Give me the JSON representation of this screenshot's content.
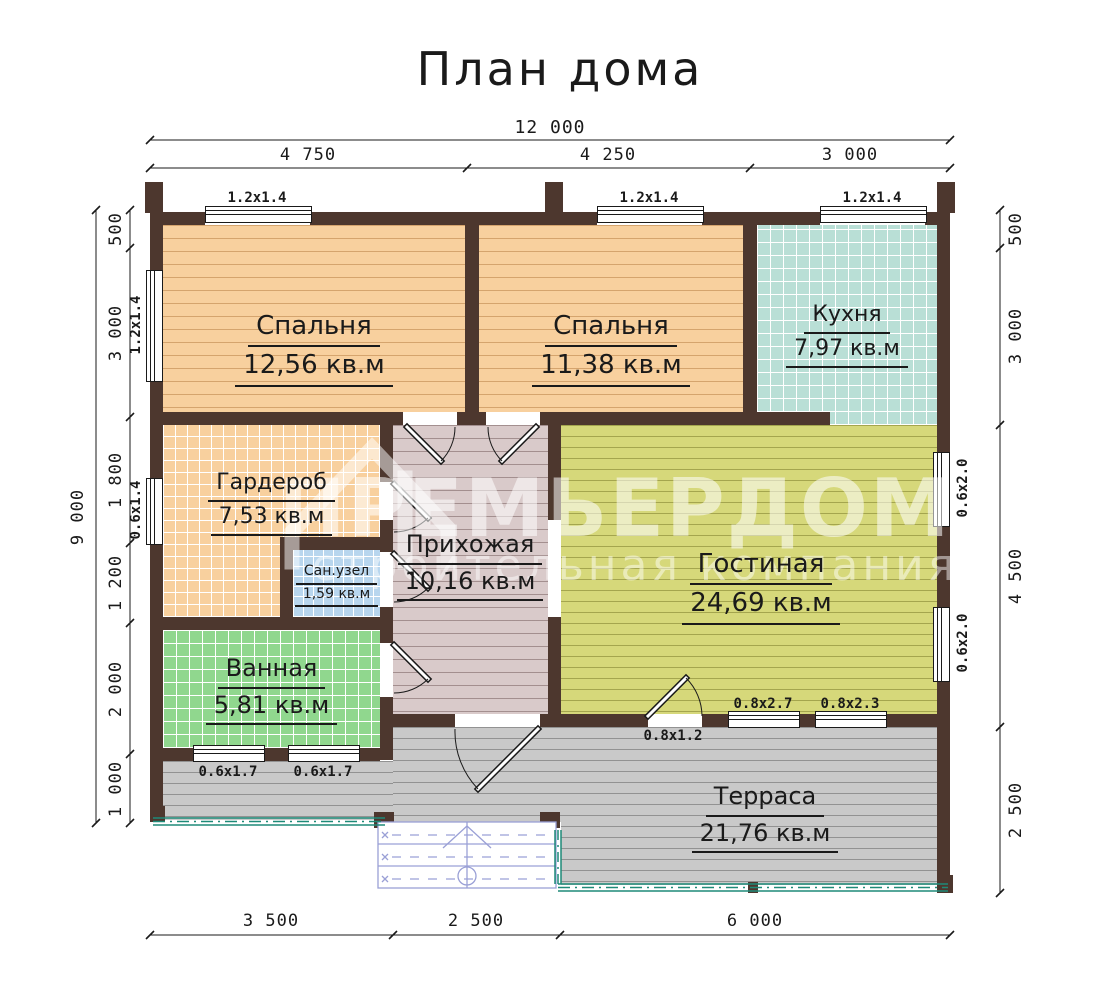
{
  "title": "План дома",
  "watermark": {
    "brand": "ПРЕМЬЕРДОМ",
    "tagline": "строительная компания"
  },
  "rooms": {
    "bedroom1": {
      "name": "Спальня",
      "area": "12,56 кв.м"
    },
    "bedroom2": {
      "name": "Спальня",
      "area": "11,38 кв.м"
    },
    "kitchen": {
      "name": "Кухня",
      "area": "7,97 кв.м"
    },
    "wardrobe": {
      "name": "Гардероб",
      "area": "7,53 кв.м"
    },
    "sanuzel": {
      "name": "Сан.узел",
      "area": "1,59 кв.м"
    },
    "hallway": {
      "name": "Прихожая",
      "area": "10,16 кв.м"
    },
    "living": {
      "name": "Гостиная",
      "area": "24,69 кв.м"
    },
    "bathroom": {
      "name": "Ванная",
      "area": "5,81 кв.м"
    },
    "terrace": {
      "name": "Терраса",
      "area": "21,76 кв.м"
    }
  },
  "dimensions": {
    "top_total": "12 000",
    "top_segments": [
      "4 750",
      "4 250",
      "3 000"
    ],
    "left_total": "9 000",
    "left_segments": [
      "500",
      "3 000",
      "1 800",
      "1 200",
      "2 000",
      "1 000"
    ],
    "right_segments": [
      "500",
      "3 000",
      "4 500",
      "2 500"
    ],
    "bottom_segments": [
      "3 500",
      "2 500",
      "6 000"
    ]
  },
  "openings": {
    "top_windows": [
      "1.2x1.4",
      "1.2x1.4",
      "1.2x1.4"
    ],
    "left_windows": [
      "1.2x1.4",
      "0.6x1.4"
    ],
    "right_windows": [
      "0.6x2.0",
      "0.6x2.0"
    ],
    "bathroom_windows": [
      "0.6x1.7",
      "0.6x1.7"
    ],
    "living_windows": [
      "0.8x2.7",
      "0.8x2.3"
    ],
    "terrace_door": "0.8x1.2"
  },
  "colors": {
    "wall": "#4d372e",
    "bedroom_floor": "#f8d09e",
    "kitchen_floor": "#b9dfd6",
    "sanuzel_floor": "#b8d6ee",
    "hallway_floor": "#d9caca",
    "living_floor": "#d6d87a",
    "bathroom_floor": "#90d78e",
    "terrace_floor": "#c9c9c9",
    "railing": "#1e8a78",
    "stairs": "#9aa0d6",
    "watermark": "rgba(255,255,255,0.5)"
  }
}
